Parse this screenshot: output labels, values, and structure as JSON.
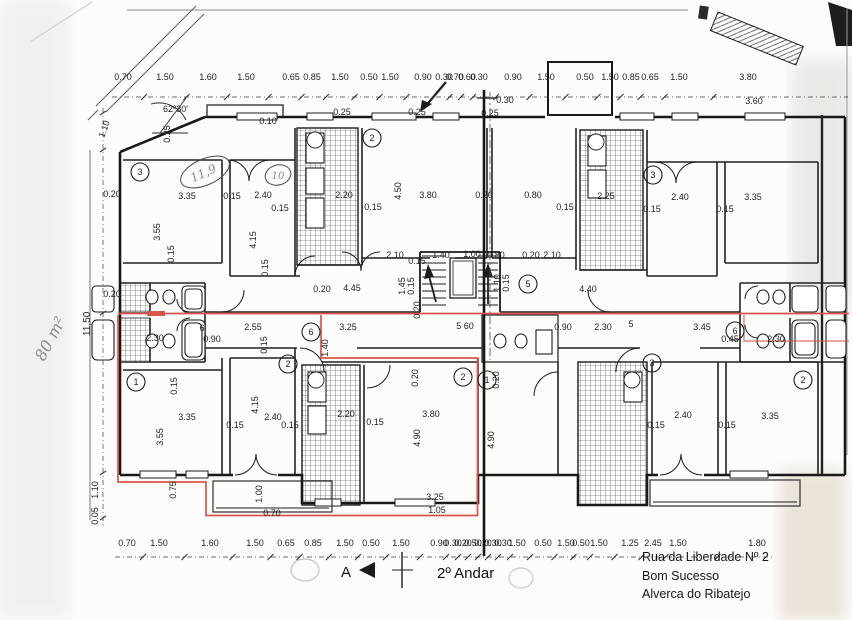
{
  "captions": {
    "floor_title": "2º Andar",
    "address_line1": "Rua da Liberdade Nº 2",
    "address_line2": "Bom Sucesso",
    "address_line3": "Alverca do Ribatejo",
    "section_marker": "A"
  },
  "notes": {
    "area_note": "80 m²",
    "angle_note": "62º30'",
    "oval_note_left": "11,9",
    "oval_note_right": "10",
    "left_height_dim": "11,50"
  },
  "colors": {
    "highlight": "#d9564a",
    "ink": "#1c1c1c",
    "pencil": "#8a8a88"
  },
  "dimensions": {
    "top_row_y": 80,
    "top_row": [
      {
        "t": "0.70",
        "x": 123
      },
      {
        "t": "1.50",
        "x": 165
      },
      {
        "t": "1.60",
        "x": 208
      },
      {
        "t": "1.50",
        "x": 246
      },
      {
        "t": "0.65",
        "x": 291
      },
      {
        "t": "0.85",
        "x": 312
      },
      {
        "t": "1.50",
        "x": 340
      },
      {
        "t": "0.50",
        "x": 369
      },
      {
        "t": "1.50",
        "x": 390
      },
      {
        "t": "0.90",
        "x": 423
      },
      {
        "t": "0.30",
        "x": 444
      },
      {
        "t": "0.70",
        "x": 455
      },
      {
        "t": "0.60",
        "x": 467
      },
      {
        "t": "0.30",
        "x": 479
      },
      {
        "t": "0.90",
        "x": 513
      },
      {
        "t": "1.50",
        "x": 546
      },
      {
        "t": "0.50",
        "x": 585
      },
      {
        "t": "1.50",
        "x": 610
      },
      {
        "t": "0.85",
        "x": 631
      },
      {
        "t": "0.65",
        "x": 650
      },
      {
        "t": "1.50",
        "x": 679
      },
      {
        "t": "3.80",
        "x": 748
      }
    ],
    "bottom_row_y": 546,
    "bottom_row": [
      {
        "t": "0.70",
        "x": 127
      },
      {
        "t": "1.50",
        "x": 159
      },
      {
        "t": "1.60",
        "x": 210
      },
      {
        "t": "1.50",
        "x": 255
      },
      {
        "t": "0.65",
        "x": 286
      },
      {
        "t": "0.85",
        "x": 313
      },
      {
        "t": "1.50",
        "x": 345
      },
      {
        "t": "0.50",
        "x": 371
      },
      {
        "t": "1.50",
        "x": 401
      },
      {
        "t": "0.90",
        "x": 439
      },
      {
        "t": "0.30",
        "x": 453
      },
      {
        "t": "0.20",
        "x": 463
      },
      {
        "t": "0.50",
        "x": 473
      },
      {
        "t": "0.20",
        "x": 483
      },
      {
        "t": "0.30",
        "x": 493
      },
      {
        "t": "0.30",
        "x": 503
      },
      {
        "t": "1.50",
        "x": 517
      },
      {
        "t": "0.50",
        "x": 543
      },
      {
        "t": "1.50",
        "x": 566
      },
      {
        "t": "0.50",
        "x": 581
      },
      {
        "t": "1.50",
        "x": 599
      },
      {
        "t": "1.25",
        "x": 630
      },
      {
        "t": "2.45",
        "x": 653
      },
      {
        "t": "1.50",
        "x": 678
      },
      {
        "t": "1.80",
        "x": 757
      }
    ]
  },
  "labels": [
    {
      "t": "3.35",
      "x": 187,
      "y": 199
    },
    {
      "t": "0.15",
      "x": 232,
      "y": 199
    },
    {
      "t": "2.40",
      "x": 263,
      "y": 198
    },
    {
      "t": "0.15",
      "x": 280,
      "y": 211
    },
    {
      "t": "0.10",
      "x": 268,
      "y": 124
    },
    {
      "t": "3.55",
      "x": 160,
      "y": 232,
      "r": -90
    },
    {
      "t": "4.15",
      "x": 256,
      "y": 240,
      "r": -90
    },
    {
      "t": "0.15",
      "x": 174,
      "y": 254,
      "r": -90
    },
    {
      "t": "0.15",
      "x": 268,
      "y": 268,
      "r": -90
    },
    {
      "t": "2.20",
      "x": 344,
      "y": 198
    },
    {
      "t": "0.15",
      "x": 373,
      "y": 210
    },
    {
      "t": "4.50",
      "x": 401,
      "y": 191,
      "r": -90
    },
    {
      "t": "3.80",
      "x": 428,
      "y": 198
    },
    {
      "t": "0.20",
      "x": 484,
      "y": 198
    },
    {
      "t": "0.25",
      "x": 342,
      "y": 115
    },
    {
      "t": "0.25",
      "x": 417,
      "y": 115
    },
    {
      "t": "0.25",
      "x": 490,
      "y": 116
    },
    {
      "t": "0.30",
      "x": 505,
      "y": 103
    },
    {
      "t": "3.60",
      "x": 754,
      "y": 104
    },
    {
      "t": "2.10",
      "x": 395,
      "y": 258
    },
    {
      "t": "0.15",
      "x": 417,
      "y": 264
    },
    {
      "t": "1.40",
      "x": 441,
      "y": 258
    },
    {
      "t": "1.00",
      "x": 472,
      "y": 257
    },
    {
      "t": "0.80",
      "x": 496,
      "y": 258
    },
    {
      "t": "0.20",
      "x": 531,
      "y": 258
    },
    {
      "t": "2.10",
      "x": 552,
      "y": 258
    },
    {
      "t": "1.45",
      "x": 405,
      "y": 286,
      "r": -90
    },
    {
      "t": "0.15",
      "x": 414,
      "y": 286,
      "r": -90
    },
    {
      "t": "1.10",
      "x": 500,
      "y": 283,
      "r": -90
    },
    {
      "t": "0.15",
      "x": 509,
      "y": 283,
      "r": -90
    },
    {
      "t": "0.20",
      "x": 420,
      "y": 310,
      "r": -90
    },
    {
      "t": "4.45",
      "x": 352,
      "y": 291
    },
    {
      "t": "0.20",
      "x": 322,
      "y": 292
    },
    {
      "t": "4.40",
      "x": 588,
      "y": 292
    },
    {
      "t": "0.80",
      "x": 533,
      "y": 198
    },
    {
      "t": "2.25",
      "x": 606,
      "y": 199
    },
    {
      "t": "0.15",
      "x": 565,
      "y": 210
    },
    {
      "t": "2.40",
      "x": 680,
      "y": 200
    },
    {
      "t": "0.15",
      "x": 652,
      "y": 212
    },
    {
      "t": "3.35",
      "x": 753,
      "y": 200
    },
    {
      "t": "0.15",
      "x": 725,
      "y": 212
    },
    {
      "t": "2.30",
      "x": 155,
      "y": 341
    },
    {
      "t": "6",
      "x": 202,
      "y": 331
    },
    {
      "t": "0.90",
      "x": 212,
      "y": 342
    },
    {
      "t": "2.55",
      "x": 253,
      "y": 330
    },
    {
      "t": "0.15",
      "x": 267,
      "y": 345,
      "r": -90
    },
    {
      "t": "3.25",
      "x": 348,
      "y": 330
    },
    {
      "t": "1.40",
      "x": 328,
      "y": 348,
      "r": -90
    },
    {
      "t": "5 60",
      "x": 465,
      "y": 329
    },
    {
      "t": "0.90",
      "x": 563,
      "y": 330
    },
    {
      "t": "2.30",
      "x": 603,
      "y": 330
    },
    {
      "t": "5",
      "x": 631,
      "y": 327
    },
    {
      "t": "3.45",
      "x": 702,
      "y": 330
    },
    {
      "t": "0.45",
      "x": 730,
      "y": 342
    },
    {
      "t": "2.30",
      "x": 776,
      "y": 342
    },
    {
      "t": "3.35",
      "x": 187,
      "y": 420
    },
    {
      "t": "0.15",
      "x": 235,
      "y": 428
    },
    {
      "t": "2.40",
      "x": 273,
      "y": 420
    },
    {
      "t": "0.15",
      "x": 290,
      "y": 428
    },
    {
      "t": "3.55",
      "x": 163,
      "y": 437,
      "r": -90
    },
    {
      "t": "4.15",
      "x": 258,
      "y": 405,
      "r": -90
    },
    {
      "t": "0.15",
      "x": 177,
      "y": 386,
      "r": -90
    },
    {
      "t": "1.00",
      "x": 262,
      "y": 494,
      "r": -90
    },
    {
      "t": "0.75",
      "x": 176,
      "y": 490,
      "r": -90
    },
    {
      "t": "0.70",
      "x": 272,
      "y": 516
    },
    {
      "t": "2.20",
      "x": 346,
      "y": 417
    },
    {
      "t": "0.15",
      "x": 375,
      "y": 425
    },
    {
      "t": "3.80",
      "x": 431,
      "y": 417
    },
    {
      "t": "4.90",
      "x": 420,
      "y": 438,
      "r": -90
    },
    {
      "t": "0.20",
      "x": 418,
      "y": 378,
      "r": -90
    },
    {
      "t": "3.25",
      "x": 435,
      "y": 500
    },
    {
      "t": "1.05",
      "x": 437,
      "y": 513
    },
    {
      "t": "4.90",
      "x": 494,
      "y": 440,
      "r": -90
    },
    {
      "t": "0.20",
      "x": 499,
      "y": 380,
      "r": -90
    },
    {
      "t": "2.40",
      "x": 683,
      "y": 418
    },
    {
      "t": "0.15",
      "x": 656,
      "y": 428
    },
    {
      "t": "0.15",
      "x": 727,
      "y": 428
    },
    {
      "t": "3.35",
      "x": 770,
      "y": 419
    },
    {
      "t": "1.10",
      "x": 107,
      "y": 130,
      "r": -70
    },
    {
      "t": "0.20",
      "x": 112,
      "y": 197
    },
    {
      "t": "0.20",
      "x": 112,
      "y": 297
    },
    {
      "t": "1.10",
      "x": 98,
      "y": 490,
      "r": -90
    },
    {
      "t": "0.05",
      "x": 98,
      "y": 516,
      "r": -90
    },
    {
      "t": "0.25",
      "x": 170,
      "y": 134,
      "r": -90
    }
  ],
  "circled_numbers": [
    {
      "t": "3",
      "x": 140,
      "y": 172
    },
    {
      "t": "2",
      "x": 372,
      "y": 138
    },
    {
      "t": "3",
      "x": 653,
      "y": 175
    },
    {
      "t": "5",
      "x": 528,
      "y": 284
    },
    {
      "t": "6",
      "x": 311,
      "y": 332
    },
    {
      "t": "6",
      "x": 735,
      "y": 331
    },
    {
      "t": "1",
      "x": 136,
      "y": 382
    },
    {
      "t": "2",
      "x": 288,
      "y": 364
    },
    {
      "t": "2",
      "x": 463,
      "y": 377
    },
    {
      "t": "1",
      "x": 487,
      "y": 380
    },
    {
      "t": "3",
      "x": 652,
      "y": 363
    },
    {
      "t": "2",
      "x": 803,
      "y": 380
    }
  ]
}
